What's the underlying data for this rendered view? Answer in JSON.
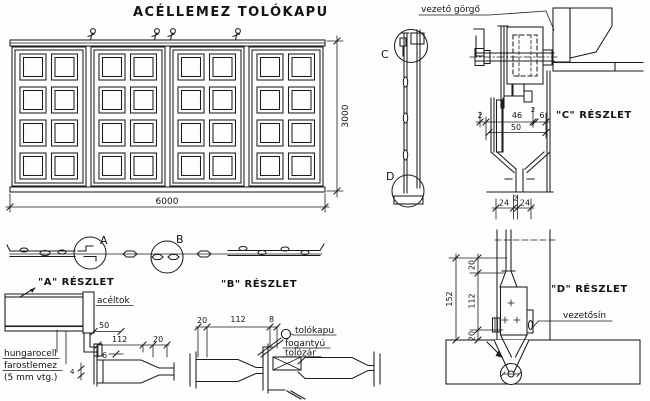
{
  "canvas": {
    "paper_color": "#fdfdfb",
    "ink_color": "#1c1c1c"
  },
  "title": "ACÉLLEMEZ TOLÓKAPU",
  "elevation": {
    "width_dim": "6000",
    "height_dim": "3000"
  },
  "plan_strip": {
    "marker_a": "A",
    "marker_b": "B"
  },
  "detail_a": {
    "title": "\"A\" RÉSZLET",
    "label_aceltok": "acéltok",
    "label_hungarocell": "hungarocell",
    "label_farostlemez": "farostlemez",
    "label_thickness": "(5 mm vtg.)",
    "dim_50": "50",
    "dim_112": "112",
    "dim_20": "20",
    "dim_6": "6",
    "dim_4": "4"
  },
  "detail_b": {
    "title": "\"B\" RÉSZLET",
    "label_tolokapu": "tolókapu",
    "label_fogantyu": "fogantyú",
    "label_tolozar": "tolózár",
    "dim_20": "20",
    "dim_112": "112",
    "dim_8": "8"
  },
  "section": {
    "marker_c": "C",
    "marker_d": "D",
    "label_guide_roller": "vezető görgő"
  },
  "detail_c": {
    "title": "\"C\" RÉSZLET",
    "dim_2_left": "2",
    "dim_46": "46",
    "dim_2_small": "2",
    "dim_6": "6",
    "dim_50": "50",
    "dim_24_left": "24",
    "dim_2_mid": "2",
    "dim_24_right": "24"
  },
  "detail_d": {
    "title": "\"D\" RÉSZLET",
    "label_guide_rail": "vezetősín",
    "dim_152": "152",
    "dim_20_top": "20",
    "dim_112": "112",
    "dim_20_bottom": "20"
  }
}
